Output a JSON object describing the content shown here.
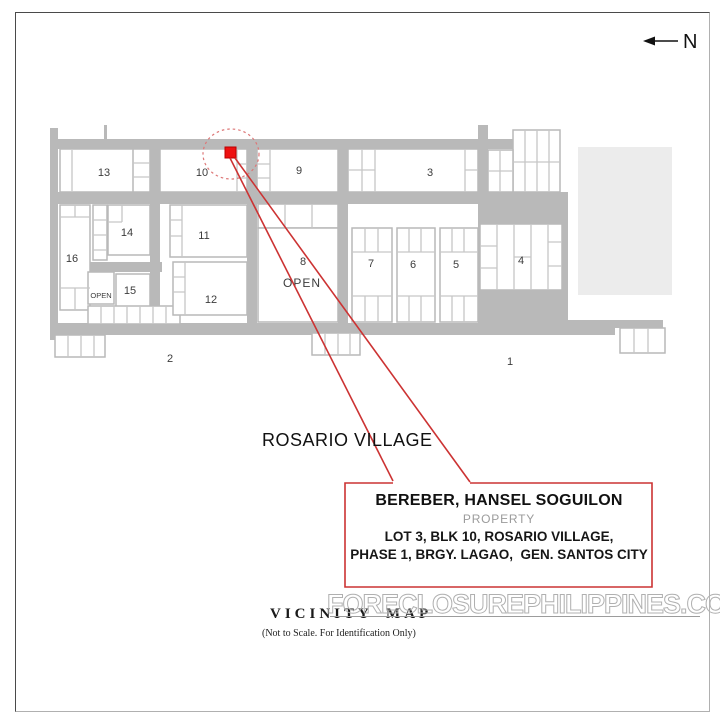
{
  "page": {
    "north_label": "N",
    "watermark": "FORECLOSUREPHILIPPINES.COM",
    "caption_title": "VICINITY MAP",
    "caption_note": "(Not to Scale. For Identification Only)"
  },
  "map": {
    "village_label": "ROSARIO VILLAGE",
    "blocks": [
      {
        "label": "13"
      },
      {
        "label": "10"
      },
      {
        "label": "9"
      },
      {
        "label": "3"
      },
      {
        "label": "16"
      },
      {
        "label": "14"
      },
      {
        "label": "11"
      },
      {
        "label": "12"
      },
      {
        "label": "15"
      },
      {
        "label": "8"
      },
      {
        "label": "7"
      },
      {
        "label": "6"
      },
      {
        "label": "5"
      },
      {
        "label": "4"
      },
      {
        "label": "2"
      },
      {
        "label": "1"
      }
    ],
    "open_labels": [
      {
        "label": "OPEN"
      },
      {
        "label": "OPEN"
      }
    ]
  },
  "callout": {
    "owner": "BEREBER, HANSEL SOGUILON",
    "type_label": "PROPERTY",
    "address_line1": "LOT 3, BLK 10, ROSARIO VILLAGE,",
    "address_line2": "PHASE 1, BRGY. LAGAO,  GEN. SANTOS CITY"
  },
  "colors": {
    "street_gray": "#b9b9b9",
    "lot_line_gray": "#c6c6c6",
    "light_block_gray": "#ececec",
    "accent_red": "#cc3333",
    "marker_red": "#ee1111",
    "highlight_ellipse_red": "#dd7777"
  }
}
